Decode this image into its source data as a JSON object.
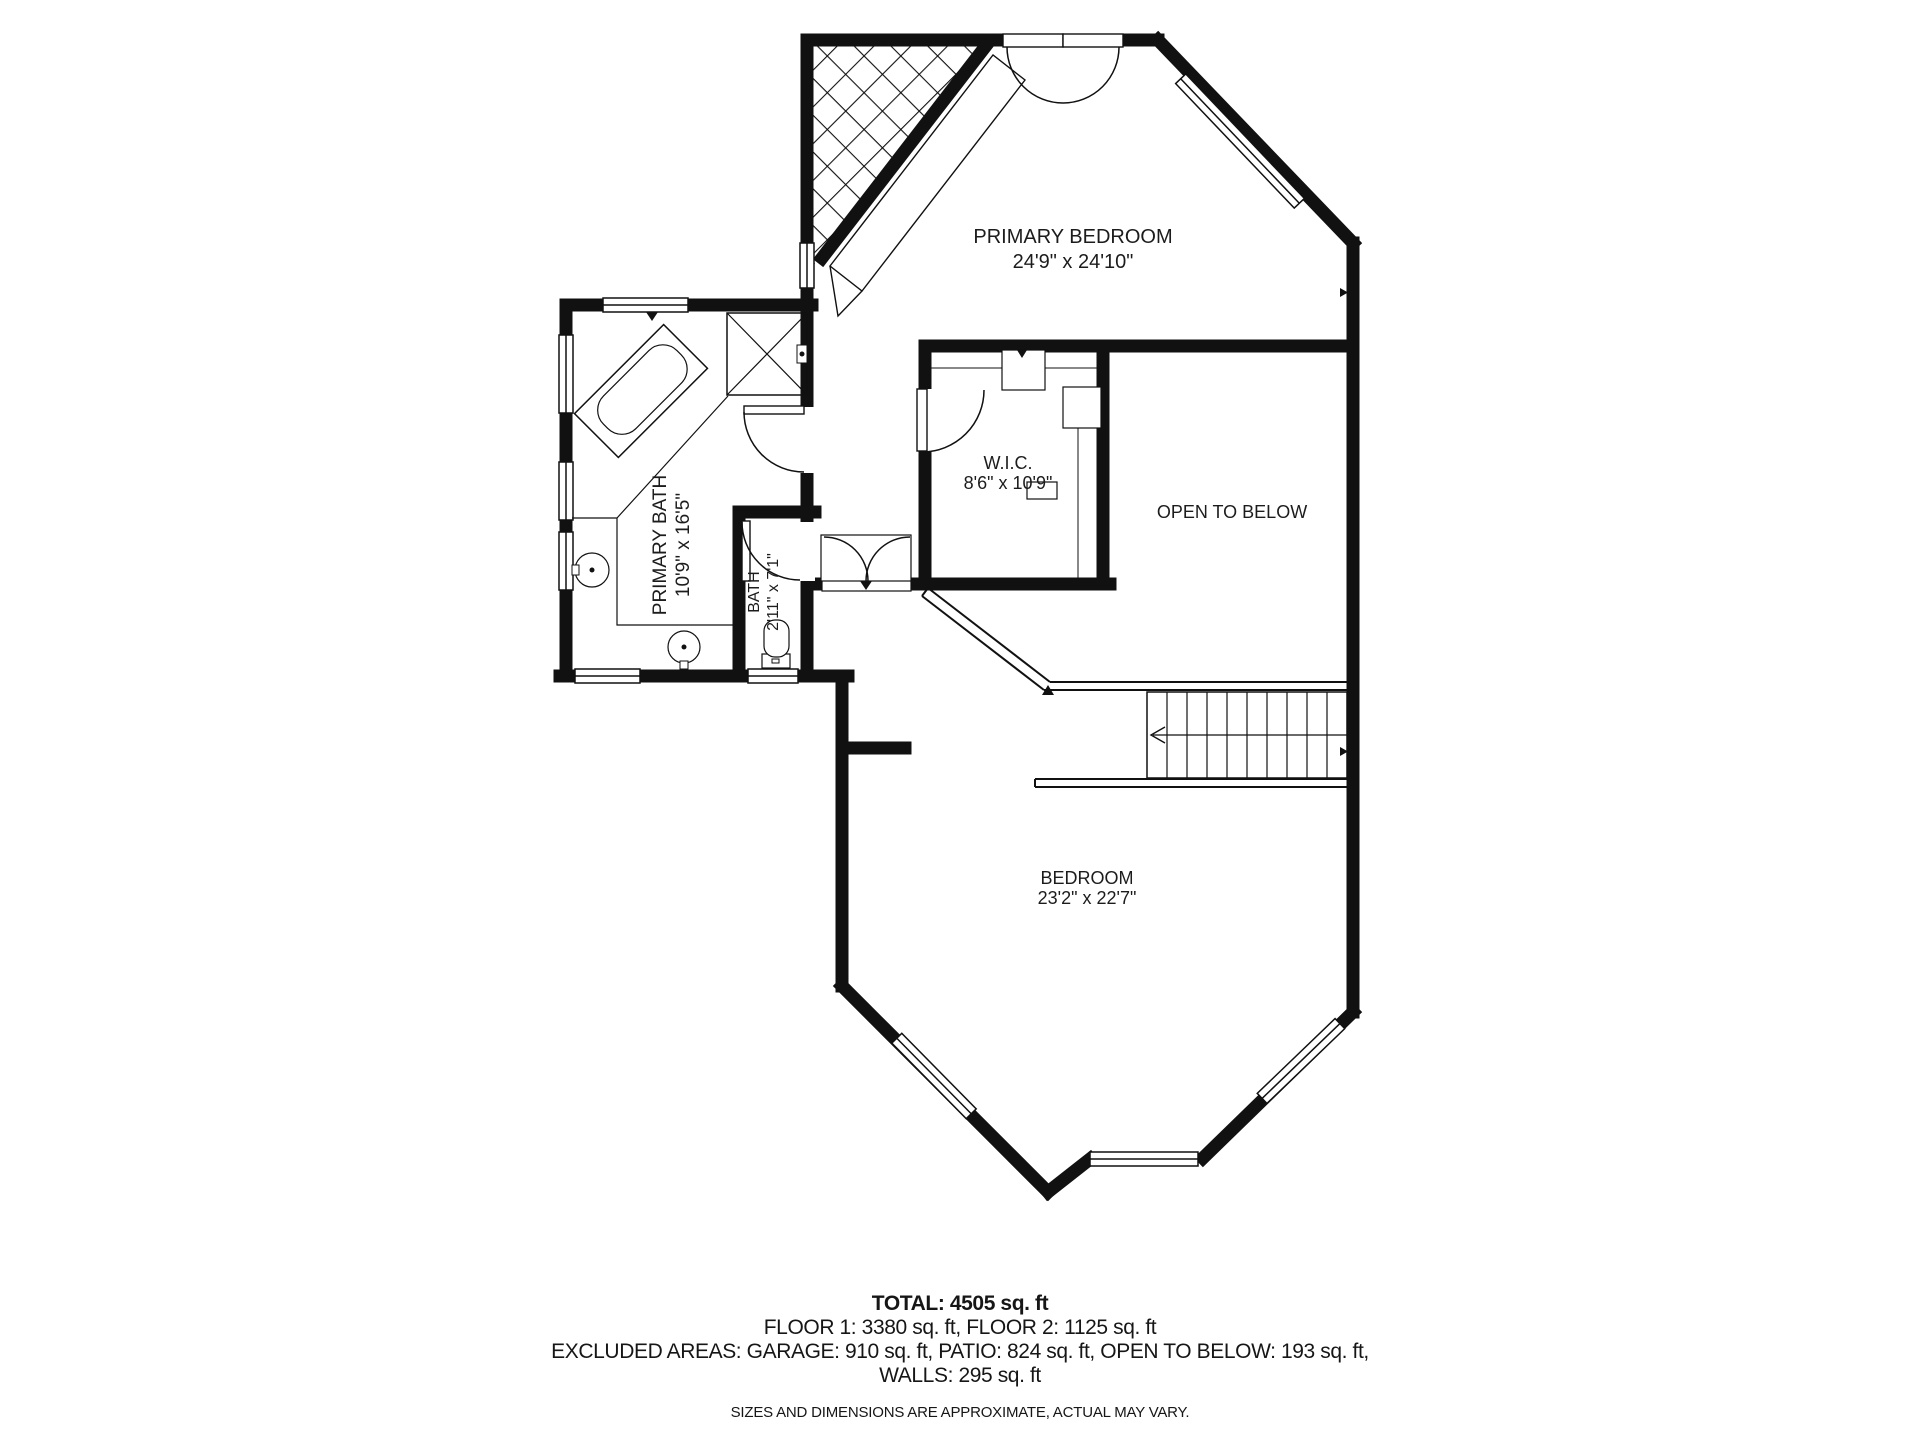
{
  "page": {
    "background_color": "#ffffff",
    "wall_color": "#111111"
  },
  "floorplan": {
    "rooms": {
      "primary_bedroom": {
        "name": "PRIMARY BEDROOM",
        "dims": "24'9\" x 24'10\""
      },
      "wic": {
        "name": "W.I.C.",
        "dims": "8'6\" x 10'9\""
      },
      "open_to_below": {
        "name": "OPEN TO BELOW"
      },
      "primary_bath": {
        "name": "PRIMARY BATH",
        "dims": "10'9\" x 16'5\""
      },
      "bath": {
        "name": "BATH",
        "dims": "2'11\" x 7'1\""
      },
      "bedroom": {
        "name": "BEDROOM",
        "dims": "23'2\" x 22'7\""
      }
    }
  },
  "footer": {
    "total": "TOTAL: 4505 sq. ft",
    "floors": "FLOOR 1: 3380 sq. ft, FLOOR 2: 1125 sq. ft",
    "excluded": "EXCLUDED AREAS: GARAGE: 910 sq. ft, PATIO: 824 sq. ft, OPEN TO BELOW: 193 sq. ft,",
    "walls": "WALLS: 295 sq. ft",
    "disclaimer": "SIZES AND DIMENSIONS ARE APPROXIMATE, ACTUAL MAY VARY."
  }
}
